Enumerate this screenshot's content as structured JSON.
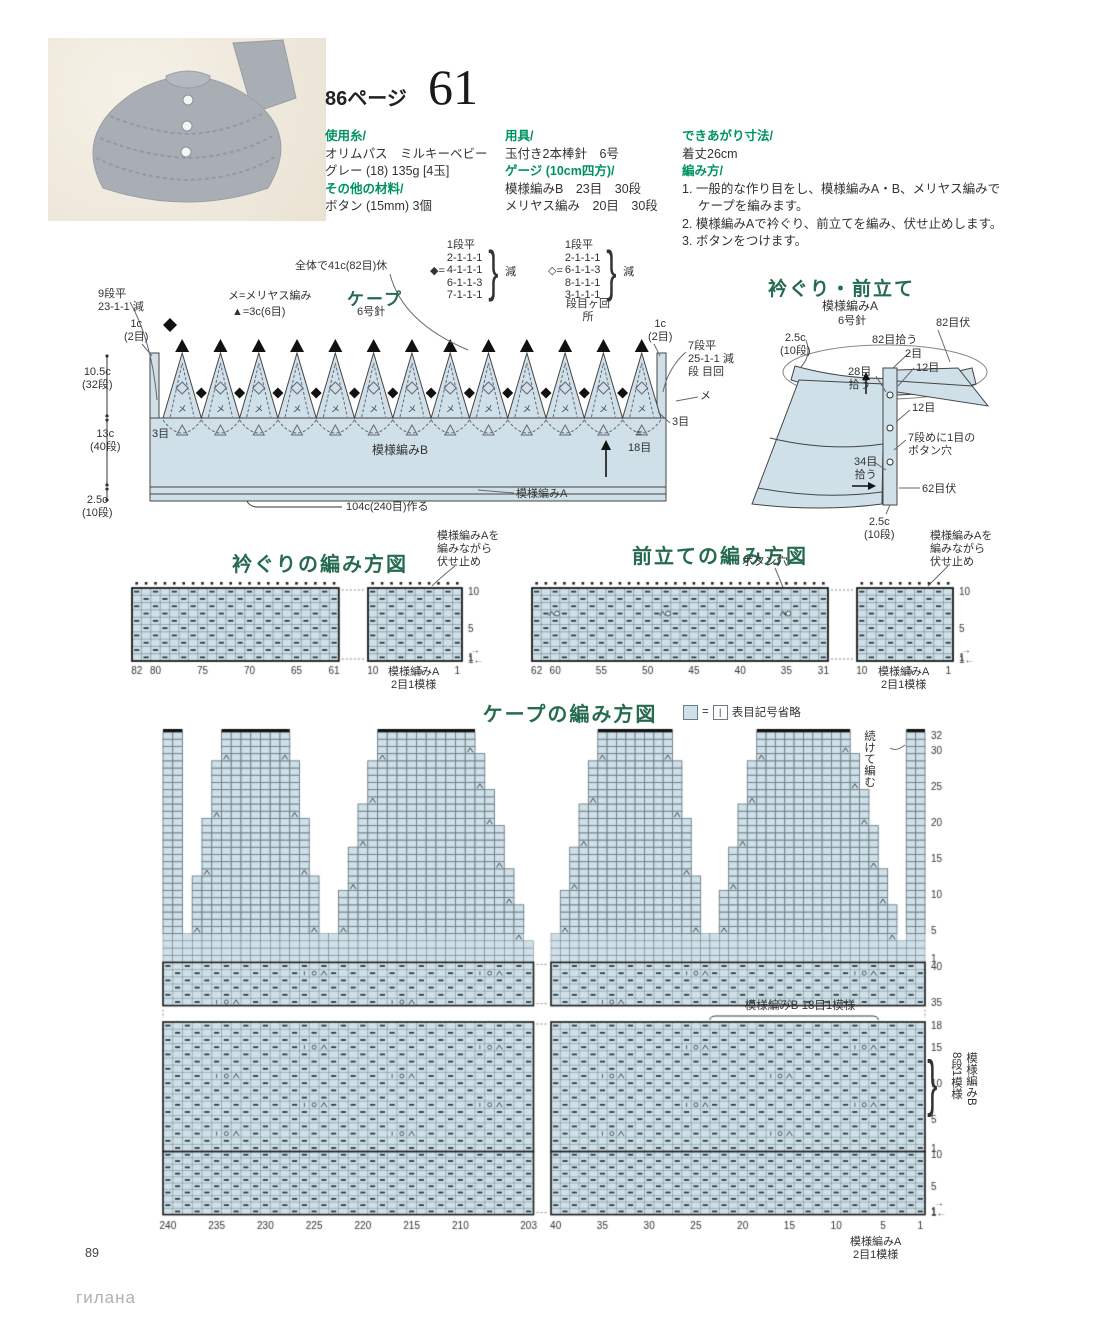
{
  "header": {
    "page_ref": "86ページ",
    "item_number": "61"
  },
  "info": {
    "yarn_heading": "使用糸/",
    "yarn_lines": [
      "オリムパス　ミルキーベビー",
      "グレー (18) 135g [4玉]"
    ],
    "other_heading": "その他の材料/",
    "other_lines": [
      "ボタン (15mm) 3個"
    ],
    "tools_heading": "用具/",
    "tools_lines": [
      "玉付き2本棒針　6号"
    ],
    "gauge_heading": "ゲージ (10cm四方)/",
    "gauge_lines": [
      "模様編みB　23目　30段",
      "メリヤス編み　20目　30段"
    ],
    "size_heading": "できあがり寸法/",
    "size_lines": [
      "着丈26cm"
    ],
    "howto_heading": "編み方/",
    "howto_steps": [
      "1. 一般的な作り目をし、模様編みA・B、メリヤス編みで",
      "　 ケープを編みます。",
      "2. 模様編みAで衿ぐり、前立てを編み、伏せ止めします。",
      "3. ボタンをつけます。"
    ]
  },
  "cape_diagram": {
    "title": "ケープ",
    "needle": "6号針",
    "legend_me": "メ=メリヤス編み",
    "legend_tri": "▲=3c(6目)",
    "hold_note": "全体で41c(82目)休",
    "left_dec": "9段平\n23-1-1 減",
    "lc_left": "1c\n(2目)",
    "lc_right": "1c\n(2目)",
    "dim_top": "10.5c\n(32段)",
    "dim_mid": "13c\n(40段)",
    "dim_bot": "2.5c\n(10段)",
    "right_dec": "7段平\n25-1-1 減\n段 目回",
    "me_mark": "メ",
    "eq_mark": "=",
    "m3_left": "3目",
    "m3_right": "3目",
    "st18": "18目",
    "pattern_b": "模様編みB",
    "pattern_a": "模様編みA",
    "cast_on": "104c(240目)作る",
    "dec_filled": {
      "sym": "◆=",
      "lines": "1段平\n2-1-1-1\n4-1-1-1\n6-1-1-3\n7-1-1-1",
      "note": "減"
    },
    "dec_open": {
      "sym": "◇=",
      "lines": "1段平\n2-1-1-1\n6-1-1-3\n8-1-1-1\n3-1-1-1",
      "note": "減",
      "sub": "段目ヶ回\n所"
    }
  },
  "neck_diagram": {
    "title": "衿ぐり・前立て",
    "sub1": "模様編みA",
    "sub2": "6号針",
    "dim_top": "2.5c\n(10段)",
    "pickup82": "82目拾う",
    "bind82": "82目伏",
    "st2": "2目",
    "pickup28": "28目\n拾う",
    "st12a": "12目",
    "st12b": "12目",
    "buttonhole": "7段めに1目の\nボタン穴",
    "pickup34": "34目\n拾う",
    "bind62": "62目伏",
    "dim_bot": "2.5c\n(10段)"
  },
  "neck_chart": {
    "title": "衿ぐりの編み方図",
    "note": "模様編みAを\n編みながら\n伏せ止め",
    "bottom_label": "模様編みA\n2目1模様",
    "bottom_numbers_left": [
      [
        "82",
        0
      ],
      [
        "80",
        2
      ],
      [
        "75",
        7
      ],
      [
        "70",
        12
      ],
      [
        "65",
        17
      ],
      [
        "61",
        21
      ]
    ],
    "bottom_numbers_right": [
      [
        "10",
        0
      ],
      [
        "5",
        5
      ],
      [
        "1",
        9
      ]
    ],
    "row_numbers": [
      [
        "10",
        10
      ],
      [
        "5",
        5
      ],
      [
        "1",
        1
      ]
    ],
    "row_arrow_top": "→",
    "row_arrow_bottom": "1←"
  },
  "placket_chart": {
    "title": "前立ての編み方図",
    "buttonhole_label": "ボタン穴",
    "note": "模様編みAを\n編みながら\n伏せ止め",
    "bottom_label": "模様編みA\n2目1模様",
    "bottom_numbers_left": [
      [
        "62",
        0
      ],
      [
        "60",
        2
      ],
      [
        "55",
        7
      ],
      [
        "50",
        12
      ],
      [
        "45",
        17
      ],
      [
        "40",
        22
      ],
      [
        "35",
        27
      ],
      [
        "31",
        31
      ]
    ],
    "bottom_numbers_right": [
      [
        "10",
        0
      ],
      [
        "5",
        5
      ],
      [
        "1",
        9
      ]
    ],
    "row_numbers": [
      [
        "10",
        10
      ],
      [
        "5",
        5
      ],
      [
        "1",
        1
      ]
    ],
    "row_arrow_top": "→",
    "row_arrow_bottom": "1←",
    "buttonhole_cols": [
      2,
      14,
      27
    ],
    "buttonhole_row": 7
  },
  "cape_chart": {
    "title": "ケープの編み方図",
    "legend_equals": "=",
    "legend_knit": "|",
    "legend_text": "表目記号省略",
    "continue_label": "続けて編む",
    "repeat_b_label": "模様編みB 18目1模様",
    "side_label": "模様編みB\n8段1模様",
    "bottom_label": "模様編みA\n2目1模様",
    "right_numbers_top": [
      [
        "32",
        32
      ],
      [
        "30",
        30
      ],
      [
        "25",
        25
      ],
      [
        "20",
        20
      ],
      [
        "15",
        15
      ],
      [
        "10",
        10
      ],
      [
        "5",
        5
      ],
      [
        "1",
        1
      ]
    ],
    "right_numbers_b_upper": [
      [
        "40",
        40
      ],
      [
        "35",
        35
      ]
    ],
    "right_numbers_b_lower": [
      [
        "18",
        18
      ],
      [
        "15",
        15
      ],
      [
        "10",
        10
      ],
      [
        "5",
        5
      ],
      [
        "1",
        1
      ]
    ],
    "right_numbers_a": [
      [
        "10",
        10
      ],
      [
        "5",
        5
      ],
      [
        "1",
        1
      ]
    ],
    "bottom_numbers_left": [
      [
        "240",
        0
      ],
      [
        "235",
        5
      ],
      [
        "230",
        10
      ],
      [
        "225",
        15
      ],
      [
        "220",
        20
      ],
      [
        "215",
        25
      ],
      [
        "210",
        30
      ],
      [
        "203",
        37
      ]
    ],
    "bottom_numbers_right": [
      [
        "40",
        0
      ],
      [
        "35",
        5
      ],
      [
        "30",
        10
      ],
      [
        "25",
        15
      ],
      [
        "20",
        20
      ],
      [
        "15",
        25
      ],
      [
        "10",
        30
      ],
      [
        "5",
        35
      ],
      [
        "1",
        39
      ]
    ],
    "row_arrow_top": "→",
    "row_arrow_bottom": "1←"
  },
  "footer": {
    "page_number": "89",
    "watermark": "гилана"
  },
  "colors": {
    "accent_green": "#00935f",
    "title_green": "#256b4e",
    "cell_blue": "#cfe0e8",
    "grid_line": "#6b7d86",
    "heavy_line": "#1c1c1c",
    "symbol_dark": "#2a3a42",
    "photo_bg": "#f3eee4",
    "cape_gray": "#a9aeb4"
  }
}
